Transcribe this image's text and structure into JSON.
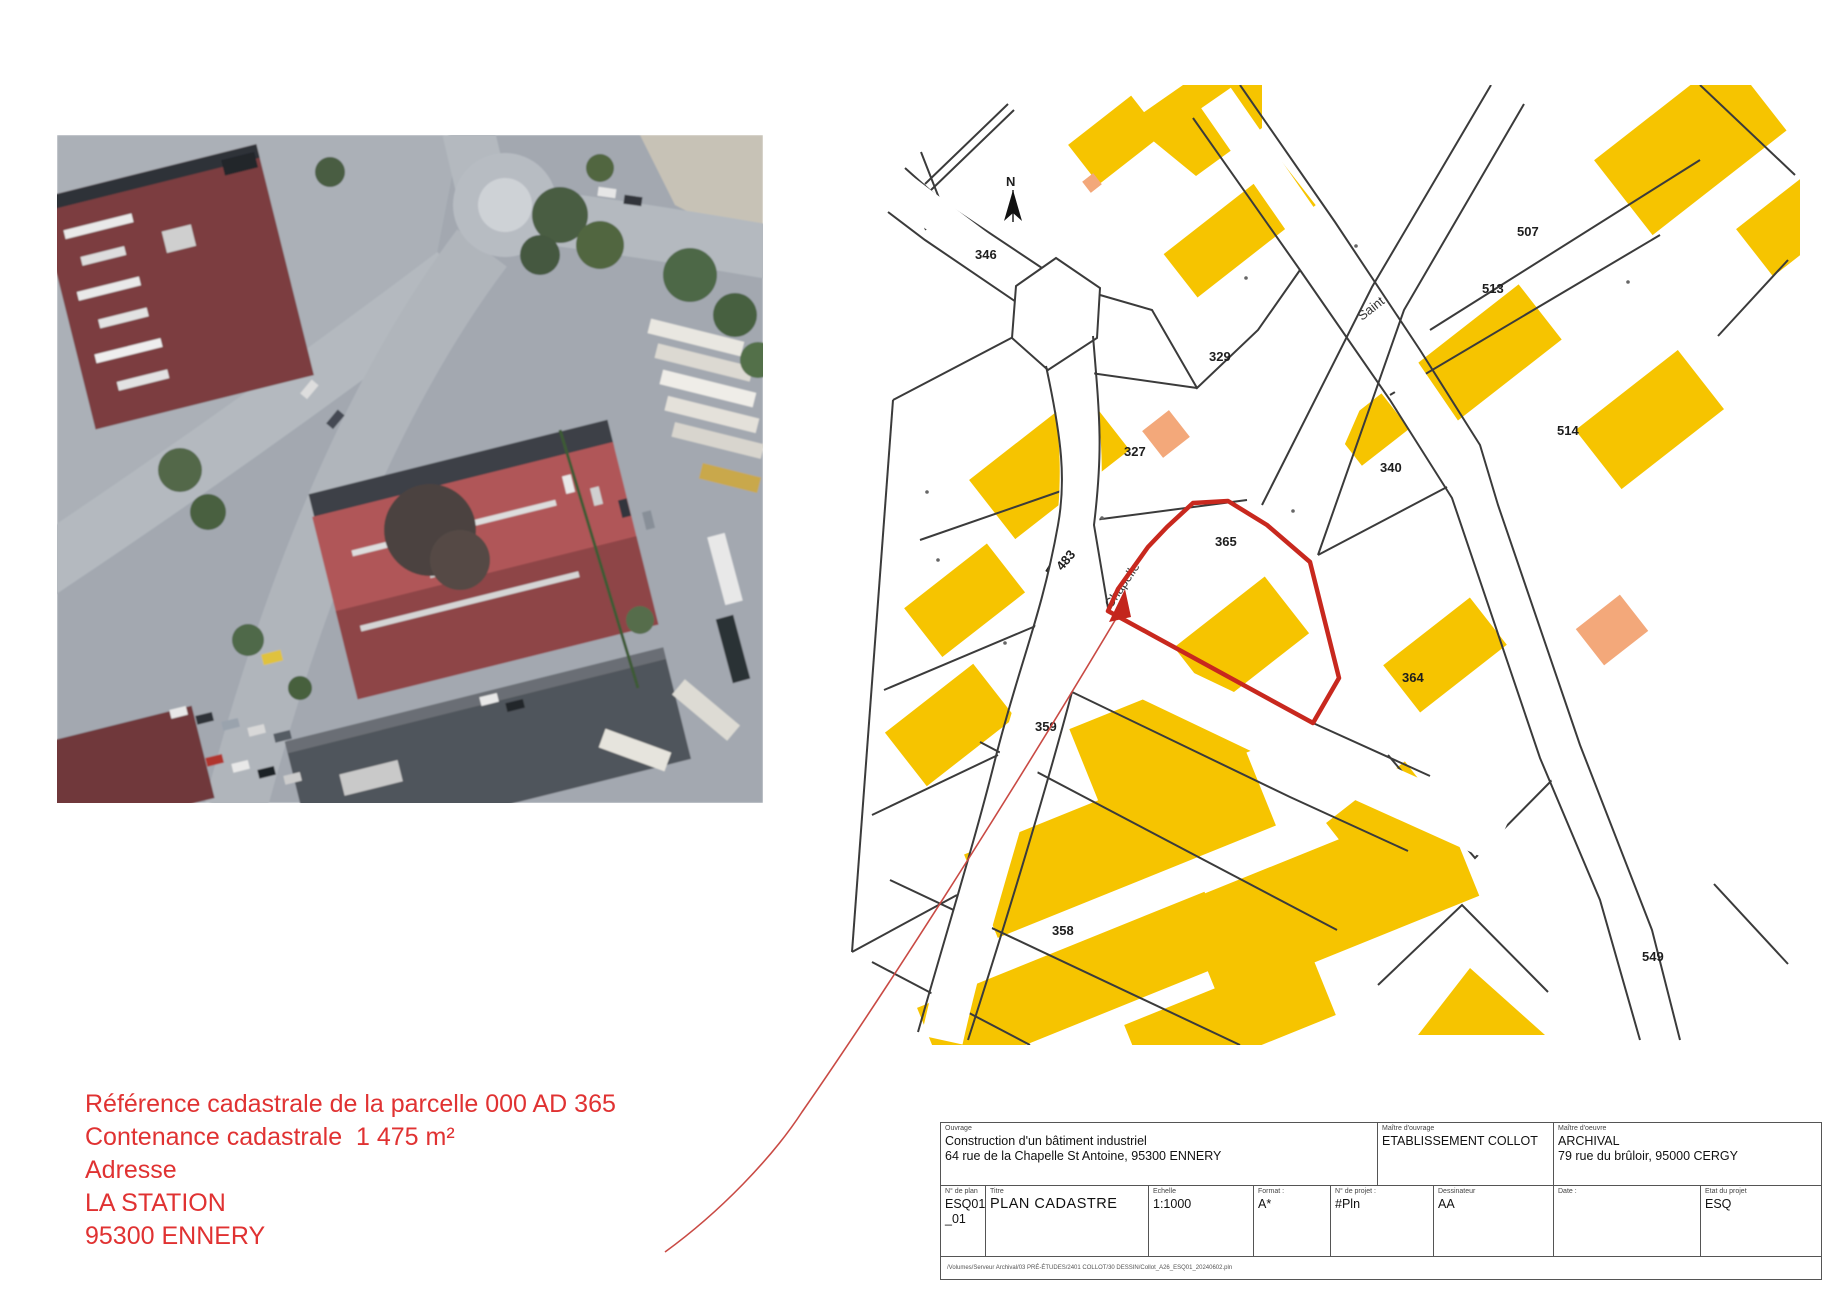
{
  "annotation": {
    "line1": "Référence cadastrale de la parcelle 000 AD 365",
    "line2": "Contenance cadastrale  1 475 m²",
    "line3": "Adresse",
    "line4": "LA STATION",
    "line5": "95300 ENNERY",
    "color": "#e03232"
  },
  "map": {
    "north_label": "N",
    "highlight_color": "#c8281e",
    "building_color": "#f6c400",
    "accent_building_color": "#f3a87a",
    "streets": [
      {
        "name": "Saint"
      },
      {
        "name": "Chapelle"
      }
    ],
    "parcels": [
      {
        "label": "346"
      },
      {
        "label": "329"
      },
      {
        "label": "327"
      },
      {
        "label": "483"
      },
      {
        "label": "365"
      },
      {
        "label": "340"
      },
      {
        "label": "507"
      },
      {
        "label": "513"
      },
      {
        "label": "514"
      },
      {
        "label": "364"
      },
      {
        "label": "359"
      },
      {
        "label": "358"
      },
      {
        "label": "549"
      }
    ]
  },
  "title_block": {
    "ouvrage_label": "Ouvrage",
    "ouvrage_line1": "Construction d'un bâtiment industriel",
    "ouvrage_line2": "64 rue de la Chapelle St Antoine, 95300 ENNERY",
    "moa_label": "Maître d'ouvrage",
    "moa_value": "ETABLISSEMENT COLLOT",
    "moe_label": "Maître d'oeuvre",
    "moe_line1": "ARCHIVAL",
    "moe_line2": "79 rue du brûloir, 95000 CERGY",
    "plan_num_label": "N° de plan",
    "plan_num_line1": "ESQ01b",
    "plan_num_line2": "_01",
    "titre_label": "Titre",
    "titre_value": "PLAN CADASTRE",
    "echelle_label": "Echelle",
    "echelle_value": "1:1000",
    "format_label": "Format :",
    "format_value": "A*",
    "projet_label": "N° de projet :",
    "projet_value": "#Pln",
    "dessinateur_label": "Dessinateur",
    "dessinateur_value": "AA",
    "date_label": "Date :",
    "date_value": "",
    "etat_label": "Etat du projet",
    "etat_value": "ESQ",
    "footer_path": "/Volumes/Serveur Archival/03 PRÉ-ÉTUDES/2401 COLLOT/30 DESSIN/Collot_A26_ESQ01_20240602.pln"
  }
}
